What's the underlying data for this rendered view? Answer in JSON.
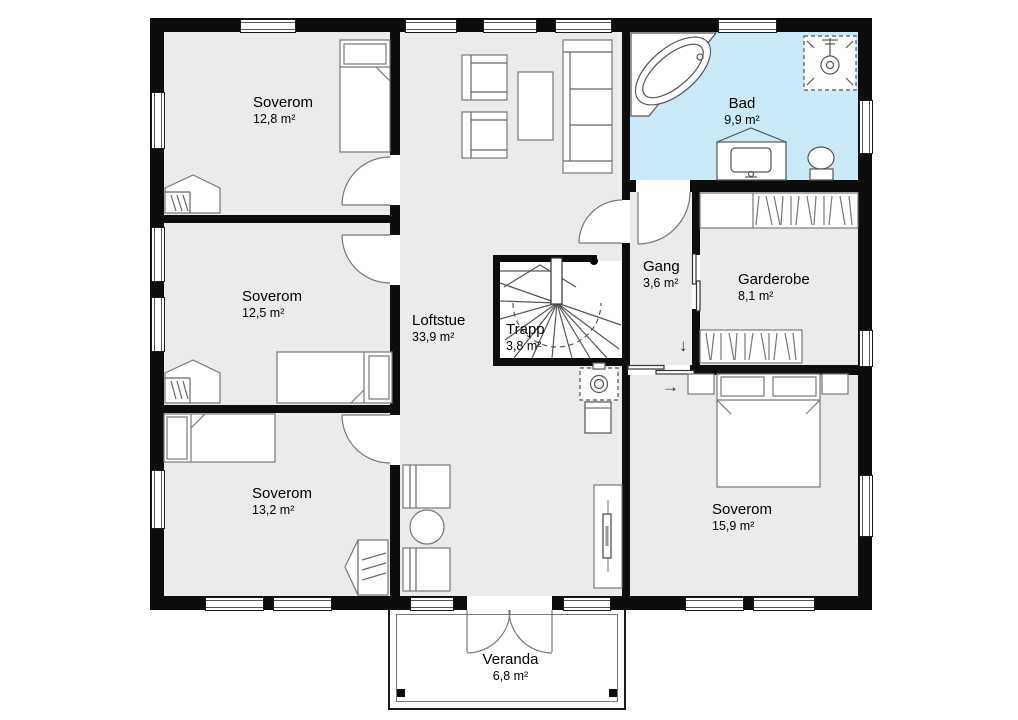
{
  "rooms": [
    {
      "name": "Soverom",
      "area": "12,8 m²"
    },
    {
      "name": "Soverom",
      "area": "12,5 m²"
    },
    {
      "name": "Soverom",
      "area": "13,2 m²"
    },
    {
      "name": "Loftstue",
      "area": "33,9 m²"
    },
    {
      "name": "Trapp",
      "area": "3,8 m²"
    },
    {
      "name": "Bad",
      "area": "9,9 m²"
    },
    {
      "name": "Gang",
      "area": "3,6 m²"
    },
    {
      "name": "Garderobe",
      "area": "8,1 m²"
    },
    {
      "name": "Soverom",
      "area": "15,9 m²"
    },
    {
      "name": "Veranda",
      "area": "6,8 m²"
    }
  ],
  "arrows": {
    "down": "↓",
    "right": "→"
  },
  "colors": {
    "wall": "#0d0d0d",
    "floor": "#ebebeb",
    "bathroom_floor": "#c9eaf6",
    "veranda_floor": "#ffffff",
    "line": "#555555"
  },
  "fixtures": [
    "single-bed",
    "double-bed",
    "wardrobe",
    "closet-shelves",
    "armchair",
    "sofa",
    "coffee-table",
    "dining-chair",
    "round-table",
    "tv-bench",
    "wood-stove",
    "chimney",
    "winder-staircase",
    "corner-bathtub",
    "shower",
    "vanity-sink",
    "toilet",
    "swing-door",
    "sliding-door",
    "french-doors"
  ]
}
